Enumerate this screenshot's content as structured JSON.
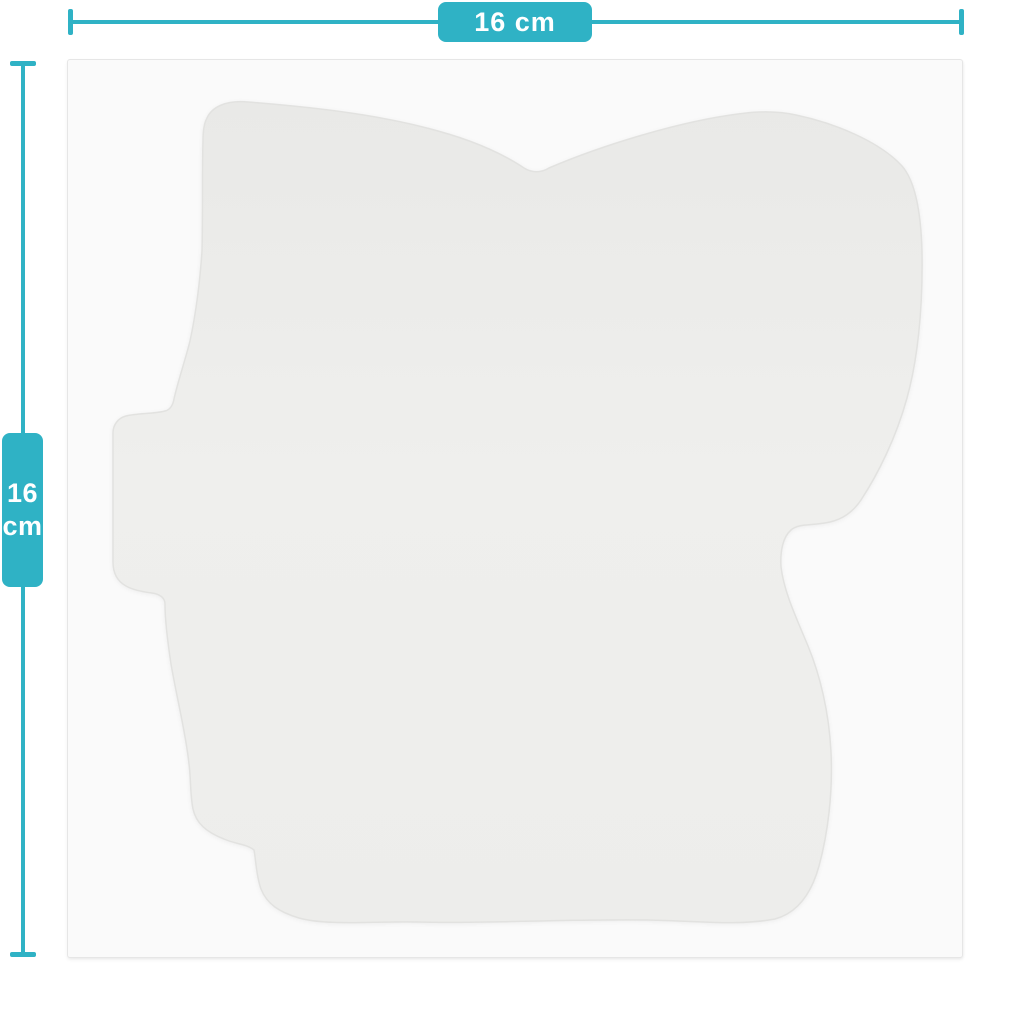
{
  "diagram": {
    "type": "product-size-diagram",
    "subject": "blank die-cut sticker sheet silhouette",
    "width_dimension": {
      "label": "16 cm"
    },
    "height_dimension": {
      "value": "16",
      "unit": "cm"
    },
    "colors": {
      "accent_teal": "#2fb2c5",
      "label_text": "#ffffff",
      "sheet_background": "#fafafa",
      "sheet_border": "#e6e6e6",
      "sticker_fill_top": "#e9e9e7",
      "sticker_fill_bottom": "#efefed",
      "sticker_edge": "#e2e2e0",
      "page_background": "#ffffff"
    }
  }
}
